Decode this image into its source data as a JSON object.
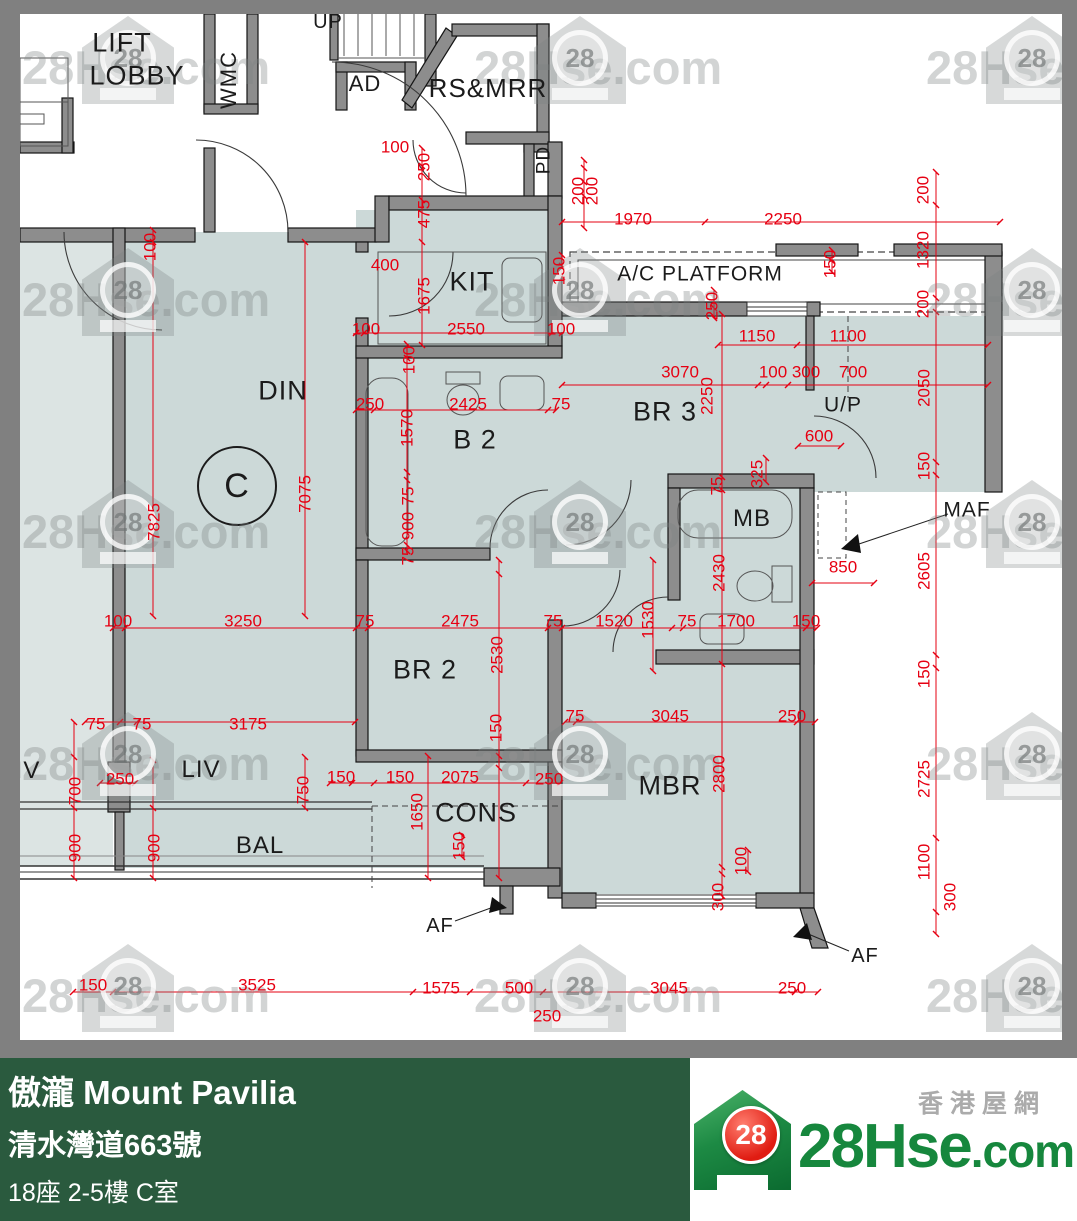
{
  "footer": {
    "title": "傲瀧 Mount Pavilia",
    "address": "清水灣道663號",
    "unit": "18座 2-5樓 C室",
    "area": "903 sqf(實用面積 Saleable Area)",
    "bg_color": "#2A5A3E"
  },
  "logo": {
    "badge": "28",
    "name_main": "28Hse",
    "name_suffix": ".com",
    "tagline": "香港屋網",
    "green": "#16873D",
    "red": "#E01C12"
  },
  "watermark": {
    "text": "28Hse.com",
    "badge": "28"
  },
  "plan": {
    "colors": {
      "room_fill": "#CCD9D8",
      "neighbor_fill": "#DCE4E3",
      "wall": "#8D8D8D",
      "dim_red": "#E60012",
      "border_gray": "#808080"
    },
    "rooms": [
      {
        "t": "LIFT",
        "x": 122,
        "y": 43,
        "s": 27
      },
      {
        "t": "LOBBY",
        "x": 137,
        "y": 76,
        "s": 27
      },
      {
        "t": "UP",
        "x": 328,
        "y": 22,
        "s": 20
      },
      {
        "t": "WMC",
        "x": 229,
        "y": 80,
        "s": 22,
        "r": 1
      },
      {
        "t": "AD",
        "x": 365,
        "y": 84,
        "s": 22
      },
      {
        "t": "RS&MRR",
        "x": 488,
        "y": 88,
        "s": 26
      },
      {
        "t": "PD",
        "x": 544,
        "y": 160,
        "s": 19,
        "r": 1
      },
      {
        "t": "KIT",
        "x": 472,
        "y": 282,
        "s": 27
      },
      {
        "t": "A/C PLATFORM",
        "x": 700,
        "y": 274,
        "s": 21
      },
      {
        "t": "DIN",
        "x": 283,
        "y": 391,
        "s": 27
      },
      {
        "t": "C",
        "x": 237,
        "y": 486,
        "s": 34
      },
      {
        "t": "B 2",
        "x": 475,
        "y": 440,
        "s": 27
      },
      {
        "t": "BR 3",
        "x": 665,
        "y": 412,
        "s": 27
      },
      {
        "t": "U/P",
        "x": 843,
        "y": 405,
        "s": 21
      },
      {
        "t": "MB",
        "x": 752,
        "y": 519,
        "s": 24
      },
      {
        "t": "MAF",
        "x": 967,
        "y": 510,
        "s": 21
      },
      {
        "t": "BR 2",
        "x": 425,
        "y": 670,
        "s": 27
      },
      {
        "t": "MBR",
        "x": 670,
        "y": 786,
        "s": 27
      },
      {
        "t": "CONS",
        "x": 476,
        "y": 813,
        "s": 27
      },
      {
        "t": "LIV",
        "x": 201,
        "y": 770,
        "s": 24
      },
      {
        "t": "IV",
        "x": 28,
        "y": 771,
        "s": 24
      },
      {
        "t": "BAL",
        "x": 260,
        "y": 846,
        "s": 24
      },
      {
        "t": "AF",
        "x": 440,
        "y": 926,
        "s": 20
      },
      {
        "t": "AF",
        "x": 865,
        "y": 956,
        "s": 20
      }
    ],
    "dims": [
      {
        "t": "100",
        "x": 395,
        "y": 147
      },
      {
        "t": "250",
        "x": 424,
        "y": 167,
        "r": 1
      },
      {
        "t": "475",
        "x": 424,
        "y": 214,
        "r": 1
      },
      {
        "t": "400",
        "x": 385,
        "y": 265
      },
      {
        "t": "1675",
        "x": 424,
        "y": 296,
        "r": 1
      },
      {
        "t": "100",
        "x": 366,
        "y": 329
      },
      {
        "t": "2550",
        "x": 466,
        "y": 329
      },
      {
        "t": "100",
        "x": 561,
        "y": 329
      },
      {
        "t": "150",
        "x": 559,
        "y": 271,
        "r": 1
      },
      {
        "t": "200",
        "x": 578,
        "y": 191,
        "r": 1
      },
      {
        "t": "200",
        "x": 592,
        "y": 191,
        "r": 1
      },
      {
        "t": "1970",
        "x": 633,
        "y": 219
      },
      {
        "t": "2250",
        "x": 783,
        "y": 219
      },
      {
        "t": "150",
        "x": 830,
        "y": 264,
        "r": 1
      },
      {
        "t": "250",
        "x": 712,
        "y": 306,
        "r": 1
      },
      {
        "t": "1150",
        "x": 757,
        "y": 336
      },
      {
        "t": "1100",
        "x": 848,
        "y": 336
      },
      {
        "t": "3070",
        "x": 680,
        "y": 372
      },
      {
        "t": "100",
        "x": 773,
        "y": 372
      },
      {
        "t": "300",
        "x": 806,
        "y": 372
      },
      {
        "t": "700",
        "x": 853,
        "y": 372
      },
      {
        "t": "2250",
        "x": 707,
        "y": 396,
        "r": 1
      },
      {
        "t": "600",
        "x": 819,
        "y": 436
      },
      {
        "t": "325",
        "x": 757,
        "y": 474,
        "r": 1
      },
      {
        "t": "75",
        "x": 717,
        "y": 486,
        "r": 1
      },
      {
        "t": "100",
        "x": 150,
        "y": 247,
        "r": 1
      },
      {
        "t": "250",
        "x": 370,
        "y": 404
      },
      {
        "t": "2425",
        "x": 468,
        "y": 404
      },
      {
        "t": "75",
        "x": 561,
        "y": 404
      },
      {
        "t": "100",
        "x": 409,
        "y": 360,
        "r": 1
      },
      {
        "t": "1570",
        "x": 407,
        "y": 428,
        "r": 1
      },
      {
        "t": "75",
        "x": 408,
        "y": 496,
        "r": 1
      },
      {
        "t": "900",
        "x": 408,
        "y": 526,
        "r": 1
      },
      {
        "t": "75",
        "x": 408,
        "y": 556,
        "r": 1
      },
      {
        "t": "7825",
        "x": 154,
        "y": 522,
        "r": 1
      },
      {
        "t": "7075",
        "x": 305,
        "y": 494,
        "r": 1
      },
      {
        "t": "100",
        "x": 118,
        "y": 621
      },
      {
        "t": "3250",
        "x": 243,
        "y": 621
      },
      {
        "t": "75",
        "x": 365,
        "y": 621
      },
      {
        "t": "2475",
        "x": 460,
        "y": 621
      },
      {
        "t": "75",
        "x": 553,
        "y": 621
      },
      {
        "t": "1520",
        "x": 614,
        "y": 621
      },
      {
        "t": "75",
        "x": 687,
        "y": 621
      },
      {
        "t": "1700",
        "x": 736,
        "y": 621
      },
      {
        "t": "150",
        "x": 806,
        "y": 621
      },
      {
        "t": "1530",
        "x": 648,
        "y": 620,
        "r": 1
      },
      {
        "t": "2530",
        "x": 497,
        "y": 655,
        "r": 1
      },
      {
        "t": "2430",
        "x": 719,
        "y": 573,
        "r": 1
      },
      {
        "t": "850",
        "x": 843,
        "y": 567
      },
      {
        "t": "2605",
        "x": 924,
        "y": 571,
        "r": 1
      },
      {
        "t": "150",
        "x": 924,
        "y": 674,
        "r": 1
      },
      {
        "t": "2725",
        "x": 924,
        "y": 779,
        "r": 1
      },
      {
        "t": "1100",
        "x": 924,
        "y": 862,
        "r": 1
      },
      {
        "t": "300",
        "x": 950,
        "y": 897,
        "r": 1
      },
      {
        "t": "200",
        "x": 923,
        "y": 190,
        "r": 1
      },
      {
        "t": "1320",
        "x": 923,
        "y": 250,
        "r": 1
      },
      {
        "t": "200",
        "x": 923,
        "y": 304,
        "r": 1
      },
      {
        "t": "2050",
        "x": 924,
        "y": 388,
        "r": 1
      },
      {
        "t": "150",
        "x": 924,
        "y": 466,
        "r": 1
      },
      {
        "t": "150",
        "x": 496,
        "y": 728,
        "r": 1
      },
      {
        "t": "75",
        "x": 575,
        "y": 716
      },
      {
        "t": "3045",
        "x": 670,
        "y": 716
      },
      {
        "t": "250",
        "x": 792,
        "y": 716
      },
      {
        "t": "2800",
        "x": 719,
        "y": 774,
        "r": 1
      },
      {
        "t": "75",
        "x": 96,
        "y": 724
      },
      {
        "t": "75",
        "x": 142,
        "y": 724
      },
      {
        "t": "3175",
        "x": 248,
        "y": 724
      },
      {
        "t": "250",
        "x": 120,
        "y": 779
      },
      {
        "t": "700",
        "x": 75,
        "y": 791,
        "r": 1
      },
      {
        "t": "900",
        "x": 75,
        "y": 848,
        "r": 1
      },
      {
        "t": "900",
        "x": 154,
        "y": 848,
        "r": 1
      },
      {
        "t": "750",
        "x": 303,
        "y": 790,
        "r": 1
      },
      {
        "t": "150",
        "x": 341,
        "y": 777
      },
      {
        "t": "150",
        "x": 400,
        "y": 777
      },
      {
        "t": "2075",
        "x": 460,
        "y": 777
      },
      {
        "t": "250",
        "x": 549,
        "y": 779
      },
      {
        "t": "1650",
        "x": 417,
        "y": 812,
        "r": 1
      },
      {
        "t": "150",
        "x": 459,
        "y": 846,
        "r": 1
      },
      {
        "t": "100",
        "x": 741,
        "y": 861,
        "r": 1
      },
      {
        "t": "300",
        "x": 718,
        "y": 897,
        "r": 1
      },
      {
        "t": "150",
        "x": 93,
        "y": 985
      },
      {
        "t": "3525",
        "x": 257,
        "y": 985
      },
      {
        "t": "1575",
        "x": 441,
        "y": 988
      },
      {
        "t": "500",
        "x": 519,
        "y": 988
      },
      {
        "t": "3045",
        "x": 669,
        "y": 988
      },
      {
        "t": "250",
        "x": 792,
        "y": 988
      },
      {
        "t": "250",
        "x": 547,
        "y": 1016
      }
    ]
  }
}
